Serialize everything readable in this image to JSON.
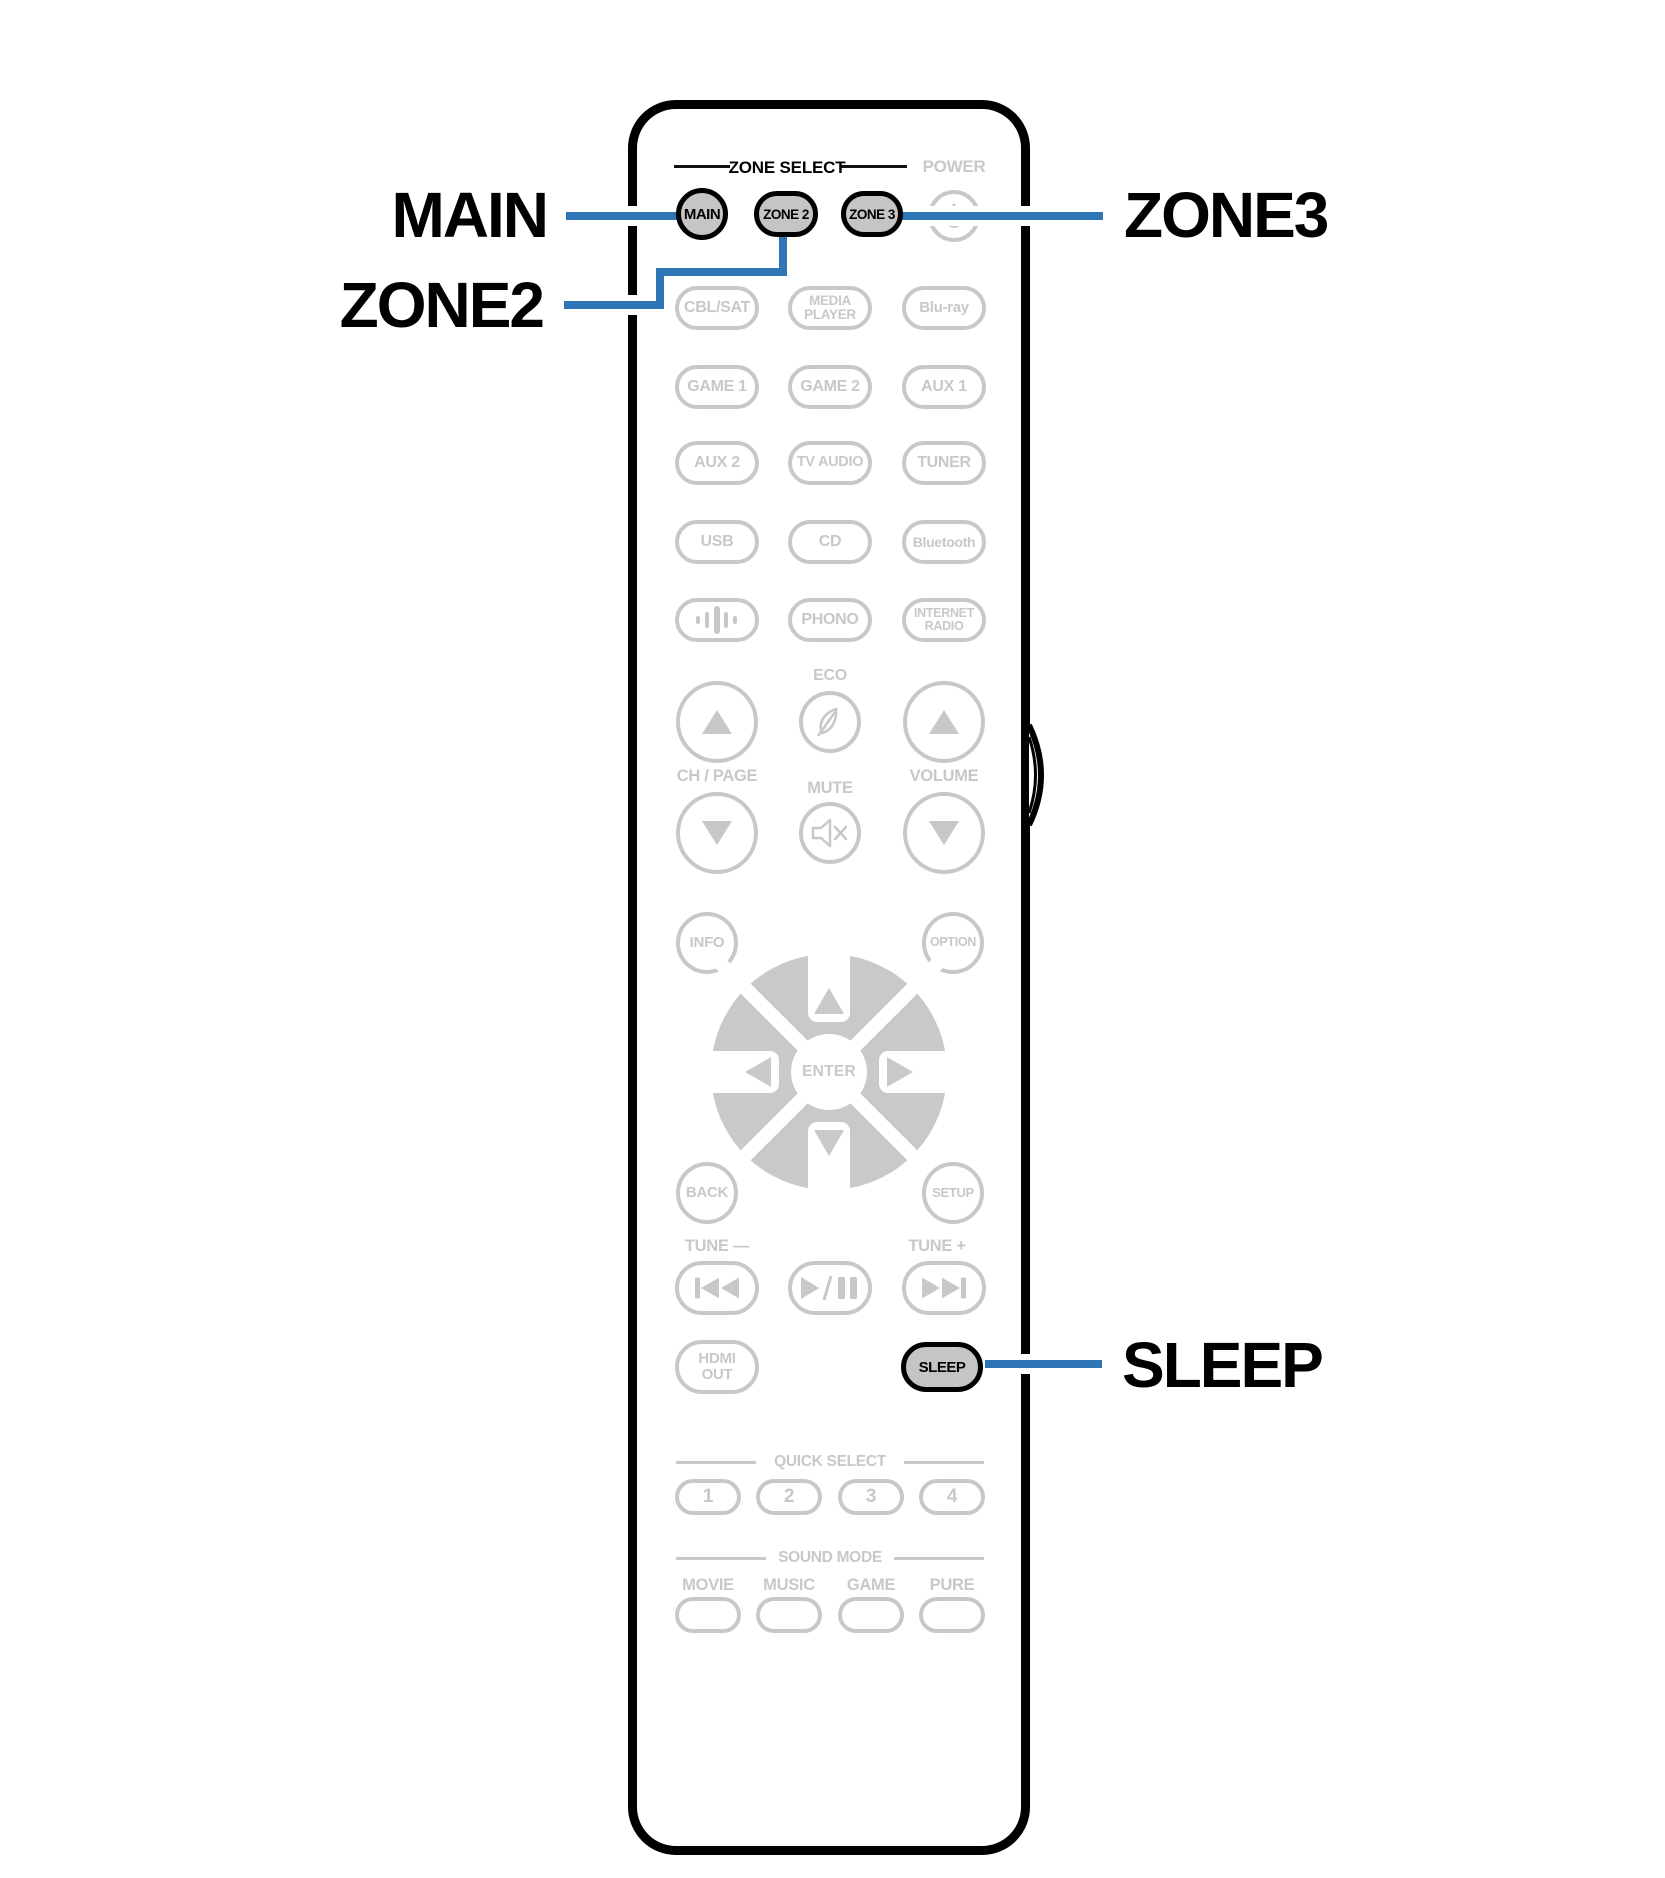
{
  "colors": {
    "accent_blue": "#2E75B6",
    "outline_gray": "#C8C8C8",
    "highlight_button_fill": "#C5C5C6",
    "black": "#000000"
  },
  "callouts": {
    "main": "MAIN",
    "zone2": "ZONE2",
    "zone3": "ZONE3",
    "sleep": "SLEEP"
  },
  "remote": {
    "zone_select_header": "ZONE SELECT",
    "power_label": "POWER",
    "zone_buttons": {
      "main": "MAIN",
      "zone2": "ZONE 2",
      "zone3": "ZONE 3"
    },
    "sources": {
      "row1": [
        "CBL/SAT",
        "MEDIA PLAYER",
        "Blu-ray"
      ],
      "row2": [
        "GAME 1",
        "GAME 2",
        "AUX 1"
      ],
      "row3": [
        "AUX 2",
        "TV AUDIO",
        "TUNER"
      ],
      "row4": [
        "USB",
        "CD",
        "Bluetooth"
      ],
      "row5_icon": "sound-bars-icon",
      "row5": [
        "PHONO",
        "INTERNET RADIO"
      ]
    },
    "volume_cluster": {
      "eco": "ECO",
      "ch_page": "CH / PAGE",
      "mute": "MUTE",
      "volume": "VOLUME"
    },
    "nav": {
      "info": "INFO",
      "option": "OPTION",
      "enter": "ENTER",
      "back": "BACK",
      "setup": "SETUP"
    },
    "tuner": {
      "tune_minus": "TUNE —",
      "tune_plus": "TUNE +"
    },
    "hdmi_out": "HDMI OUT",
    "sleep_button": "SLEEP",
    "quick_select": {
      "header": "QUICK SELECT",
      "buttons": [
        "1",
        "2",
        "3",
        "4"
      ]
    },
    "sound_mode": {
      "header": "SOUND MODE",
      "labels": [
        "MOVIE",
        "MUSIC",
        "GAME",
        "PURE"
      ]
    }
  }
}
